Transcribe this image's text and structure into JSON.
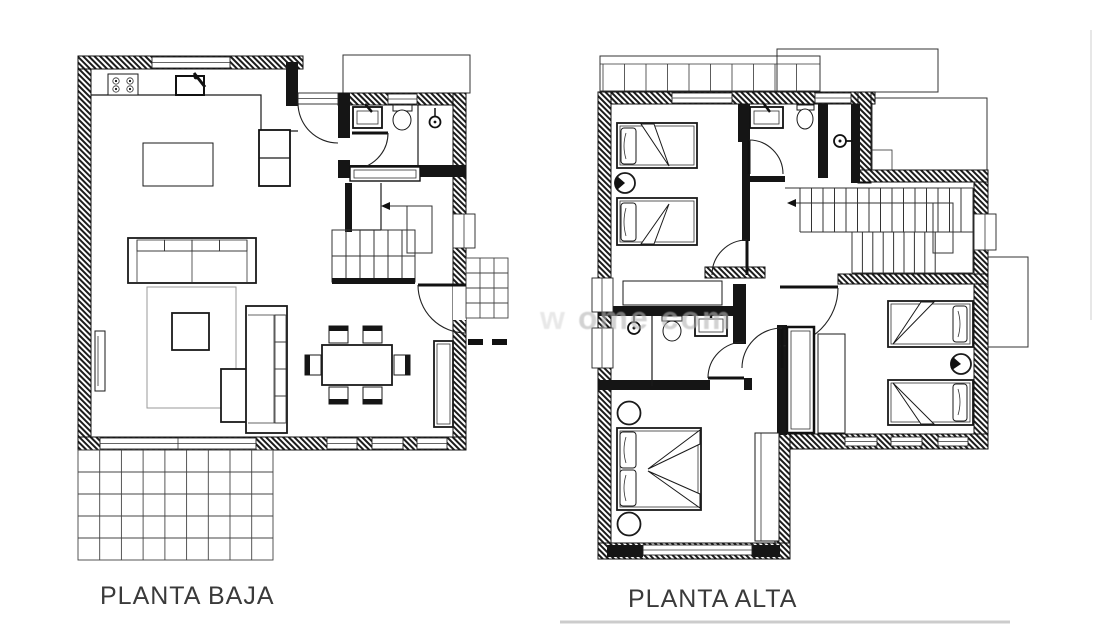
{
  "document": {
    "type": "architectural floor plan drawing"
  },
  "colors": {
    "ink": "#1a1a1a",
    "thin": "#333333",
    "rug": "#9a9a9a",
    "label": "#3a3a3a",
    "watermark": "#b5b5b5",
    "bg": "#ffffff"
  },
  "plans": {
    "left": {
      "label": "PLANTA BAJA"
    },
    "right": {
      "label": "PLANTA ALTA"
    }
  },
  "watermark": {
    "fragment_left": "w",
    "fragment_right": "ome com"
  }
}
